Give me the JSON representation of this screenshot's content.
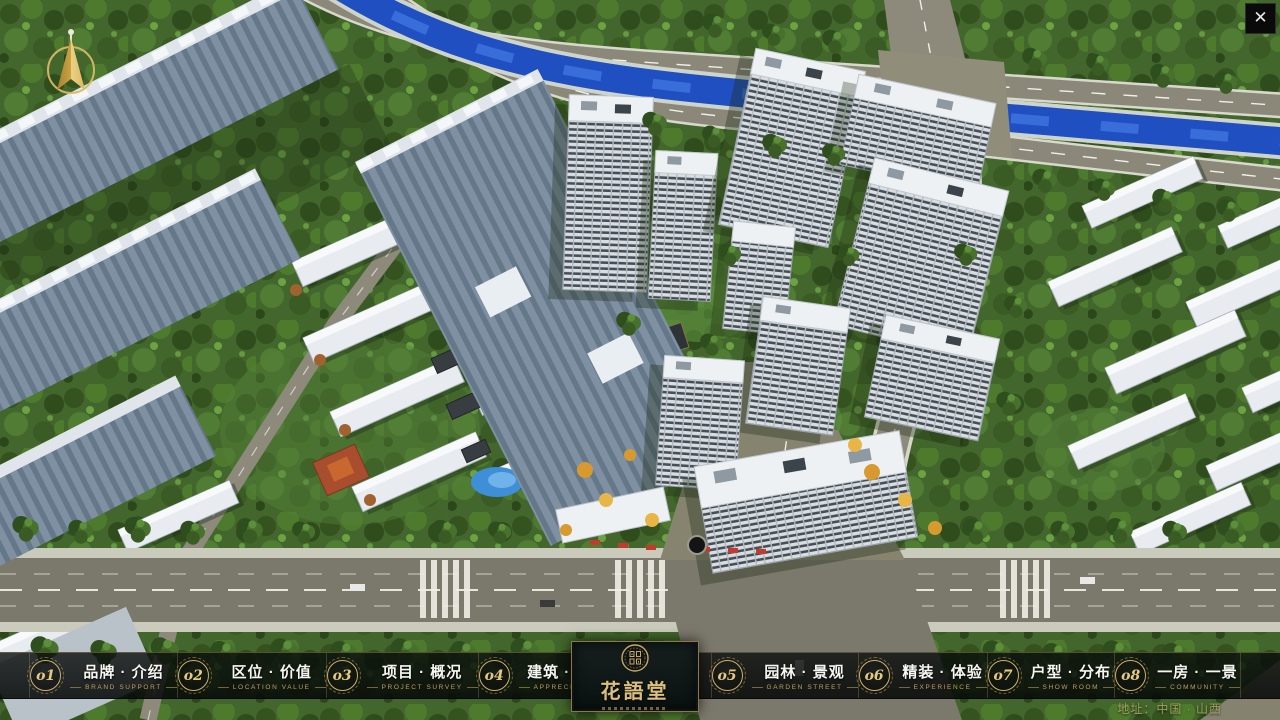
{
  "icons": {
    "close": "✕",
    "compass": "north-arrow",
    "logo_emblem": "seal-medallion"
  },
  "colors": {
    "accent_gold": "#c9a767",
    "panel_dark": "#0d1413",
    "river_blue": "#2455c4",
    "foliage_green": "#47702d",
    "road_grey": "#7b786c"
  },
  "nav": {
    "items": [
      {
        "num": "o1",
        "title": "品牌 · 介绍",
        "subtitle": "BRAND SUPPORT"
      },
      {
        "num": "o2",
        "title": "区位 · 价值",
        "subtitle": "LOCATION VALUE"
      },
      {
        "num": "o3",
        "title": "项目 · 概况",
        "subtitle": "PROJECT SURVEY"
      },
      {
        "num": "o4",
        "title": "建筑 · 鉴赏",
        "subtitle": "APPRECIATION"
      },
      {
        "num": "o5",
        "title": "园林 · 景观",
        "subtitle": "GARDEN STREET"
      },
      {
        "num": "o6",
        "title": "精装 · 体验",
        "subtitle": "EXPERIENCE"
      },
      {
        "num": "o7",
        "title": "户型 · 分布",
        "subtitle": "SHOW ROOM"
      },
      {
        "num": "o8",
        "title": "一房 · 一景",
        "subtitle": "COMMUNITY"
      }
    ],
    "logo": {
      "title": "花語堂"
    }
  },
  "footer": {
    "address": "地址：中国 · 山西"
  }
}
